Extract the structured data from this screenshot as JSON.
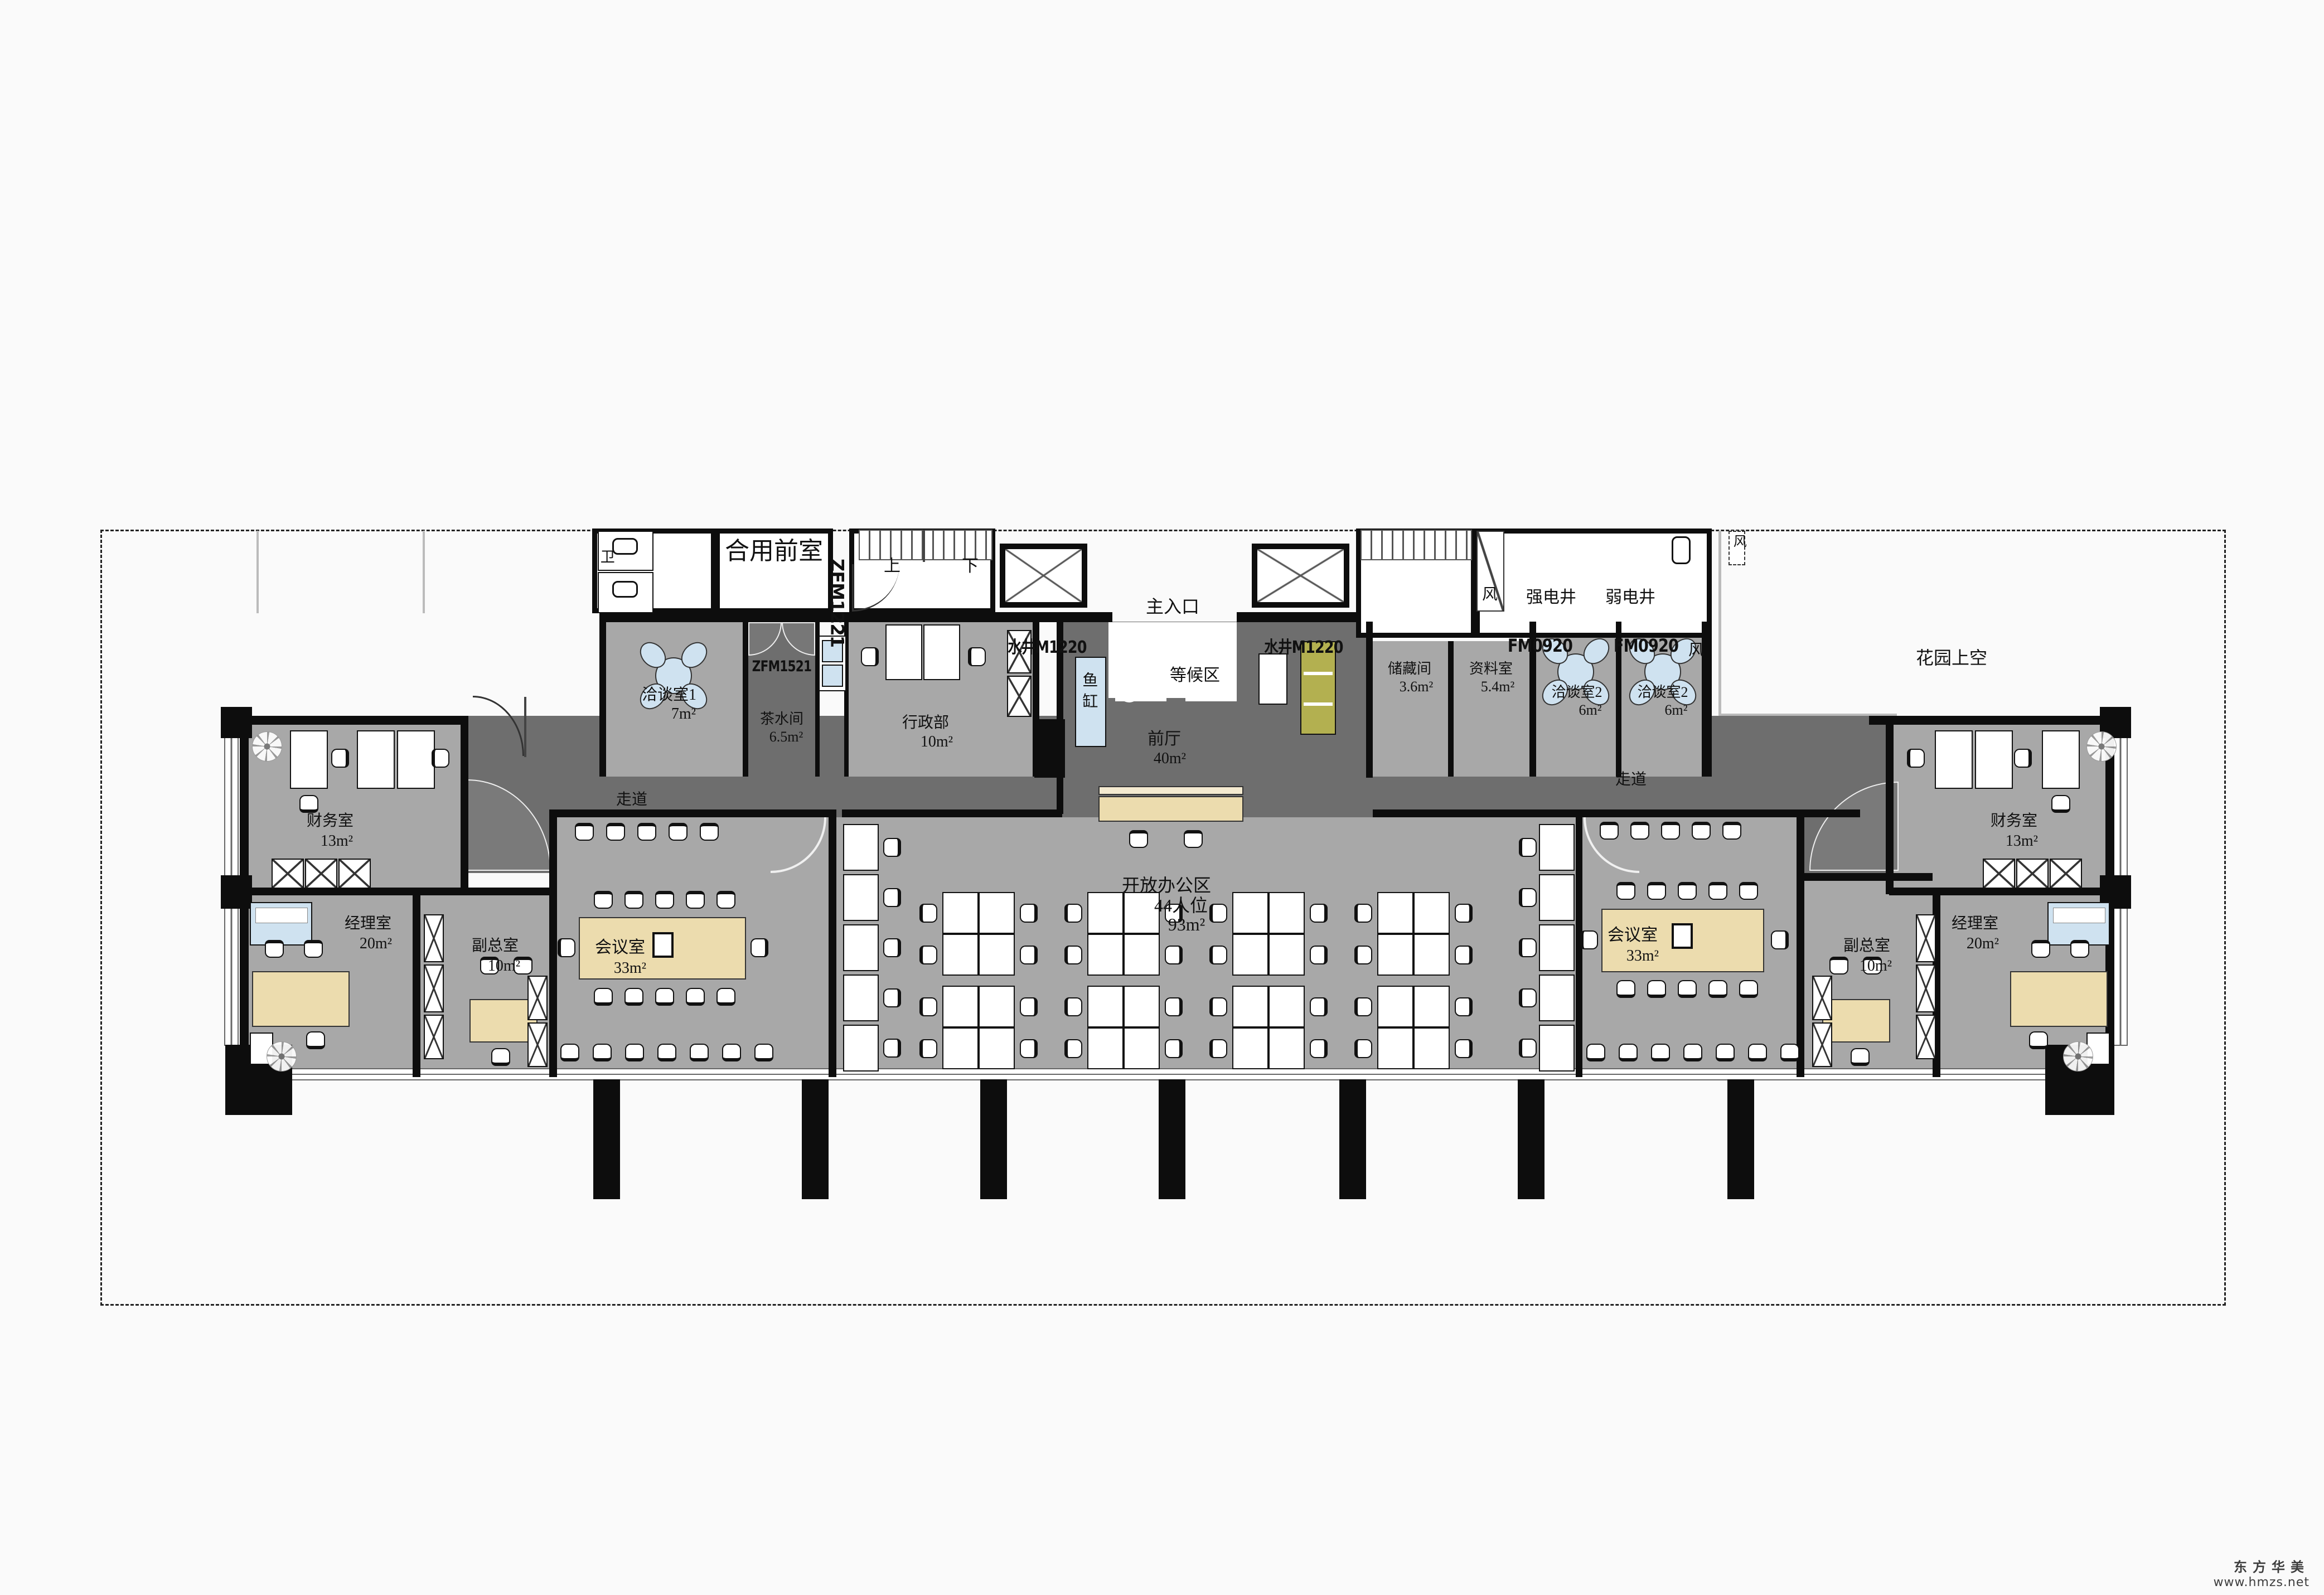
{
  "labels": {
    "wc": "卫",
    "shared_front_room": "合用前室",
    "door_zfm1221": "ZFM1221",
    "stair_up": "上",
    "stair_down": "下",
    "water_well": "水井M1220",
    "main_entrance": "主入口",
    "vent": "风",
    "strong_shaft": "强电井",
    "weak_shaft": "弱电井",
    "door_fm0920": "FM0920",
    "garden": "花园上空",
    "meeting1_name": "洽谈室1",
    "meeting1_area": "7m²",
    "door_zfm1521": "ZFM1521",
    "tea_name": "茶水间",
    "tea_area": "6.5m²",
    "admin_name": "行政部",
    "admin_area": "10m²",
    "fish_tank": "鱼缸",
    "waiting_area": "等候区",
    "hall_name": "前厅",
    "hall_area": "40m²",
    "storage_name": "储藏间",
    "storage_area": "3.6m²",
    "archive_name": "资料室",
    "archive_area": "5.4m²",
    "meeting2_name": "洽谈室2",
    "meeting2_area": "6m²",
    "corridor": "走道",
    "finance_name": "财务室",
    "finance_area": "13m²",
    "manager_name": "经理室",
    "manager_area": "20m²",
    "deputy_name": "副总室",
    "deputy_area": "10m²",
    "conference_name": "会议室",
    "conference_area": "33m²",
    "open_office_name": "开放办公区",
    "open_office_seats": "44人位",
    "open_office_area": "93m²"
  },
  "watermark": {
    "brand": "东方华美",
    "url": "www.hmzs.net"
  },
  "colors": {
    "room_gray": "#a8a8a8",
    "corridor_gray": "#6e6e6e",
    "wall_black": "#0d0d0d",
    "table_tan": "#ecdcae",
    "accent_blue": "#cfe2f0",
    "sofa_olive": "#b3b050"
  }
}
